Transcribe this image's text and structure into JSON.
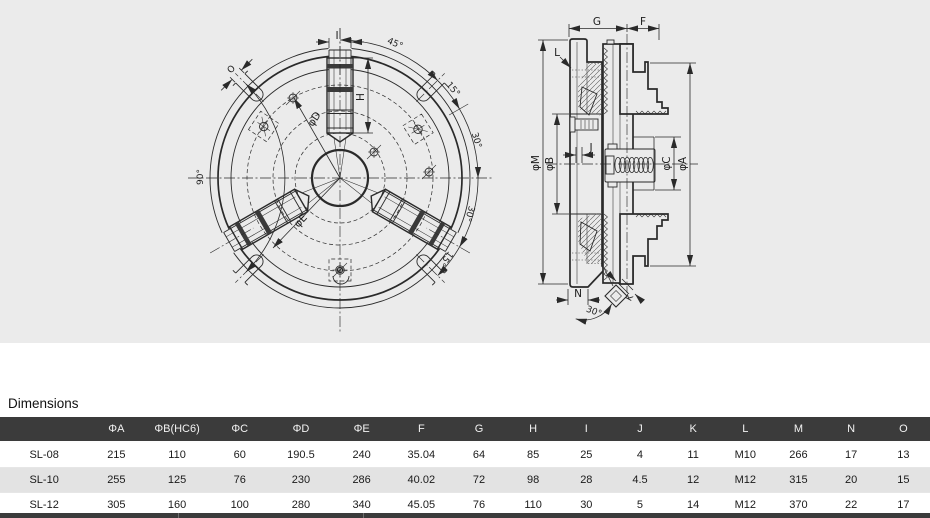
{
  "colors": {
    "canvas_bg": "#ebebeb",
    "line": "#2a2a2a",
    "table_header_bg": "#3b3b3b",
    "table_header_text": "#f2f2f2",
    "row_alt_bg": "#e3e3e3",
    "text": "#1a1a1a"
  },
  "drawing": {
    "front_view": {
      "labels": {
        "dim_i": "I",
        "dim_h": "H",
        "dia_d": "φD",
        "dia_e": "φE",
        "dim_o": "O",
        "angle_45": "45°",
        "angle_15_upper": "15°",
        "angle_30_upper": "30°",
        "angle_90": "90°",
        "angle_30_lower": "30°",
        "angle_15_lower": "15°"
      }
    },
    "side_view": {
      "labels": {
        "dim_g": "G",
        "dim_f": "F",
        "dim_l": "L",
        "dia_m": "φM",
        "dia_b": "φB",
        "dim_j": "J",
        "dia_c": "φC",
        "dia_a": "φA",
        "dim_n": "N",
        "dim_k": "K",
        "angle_30": "30°"
      }
    }
  },
  "dimensions_section": {
    "title": "Dimensions",
    "table": {
      "columns": [
        "",
        "ΦA",
        "ΦB(HC6)",
        "ΦC",
        "ΦD",
        "ΦE",
        "F",
        "G",
        "H",
        "I",
        "J",
        "K",
        "L",
        "M",
        "N",
        "O"
      ],
      "rows": [
        {
          "model": "SL-08",
          "values": [
            "215",
            "110",
            "60",
            "190.5",
            "240",
            "35.04",
            "64",
            "85",
            "25",
            "4",
            "11",
            "M10",
            "266",
            "17",
            "13"
          ]
        },
        {
          "model": "SL-10",
          "values": [
            "255",
            "125",
            "76",
            "230",
            "286",
            "40.02",
            "72",
            "98",
            "28",
            "4.5",
            "12",
            "M12",
            "315",
            "20",
            "15"
          ]
        },
        {
          "model": "SL-12",
          "values": [
            "305",
            "160",
            "100",
            "280",
            "340",
            "45.05",
            "76",
            "110",
            "30",
            "5",
            "14",
            "M12",
            "370",
            "22",
            "17"
          ]
        }
      ]
    }
  }
}
